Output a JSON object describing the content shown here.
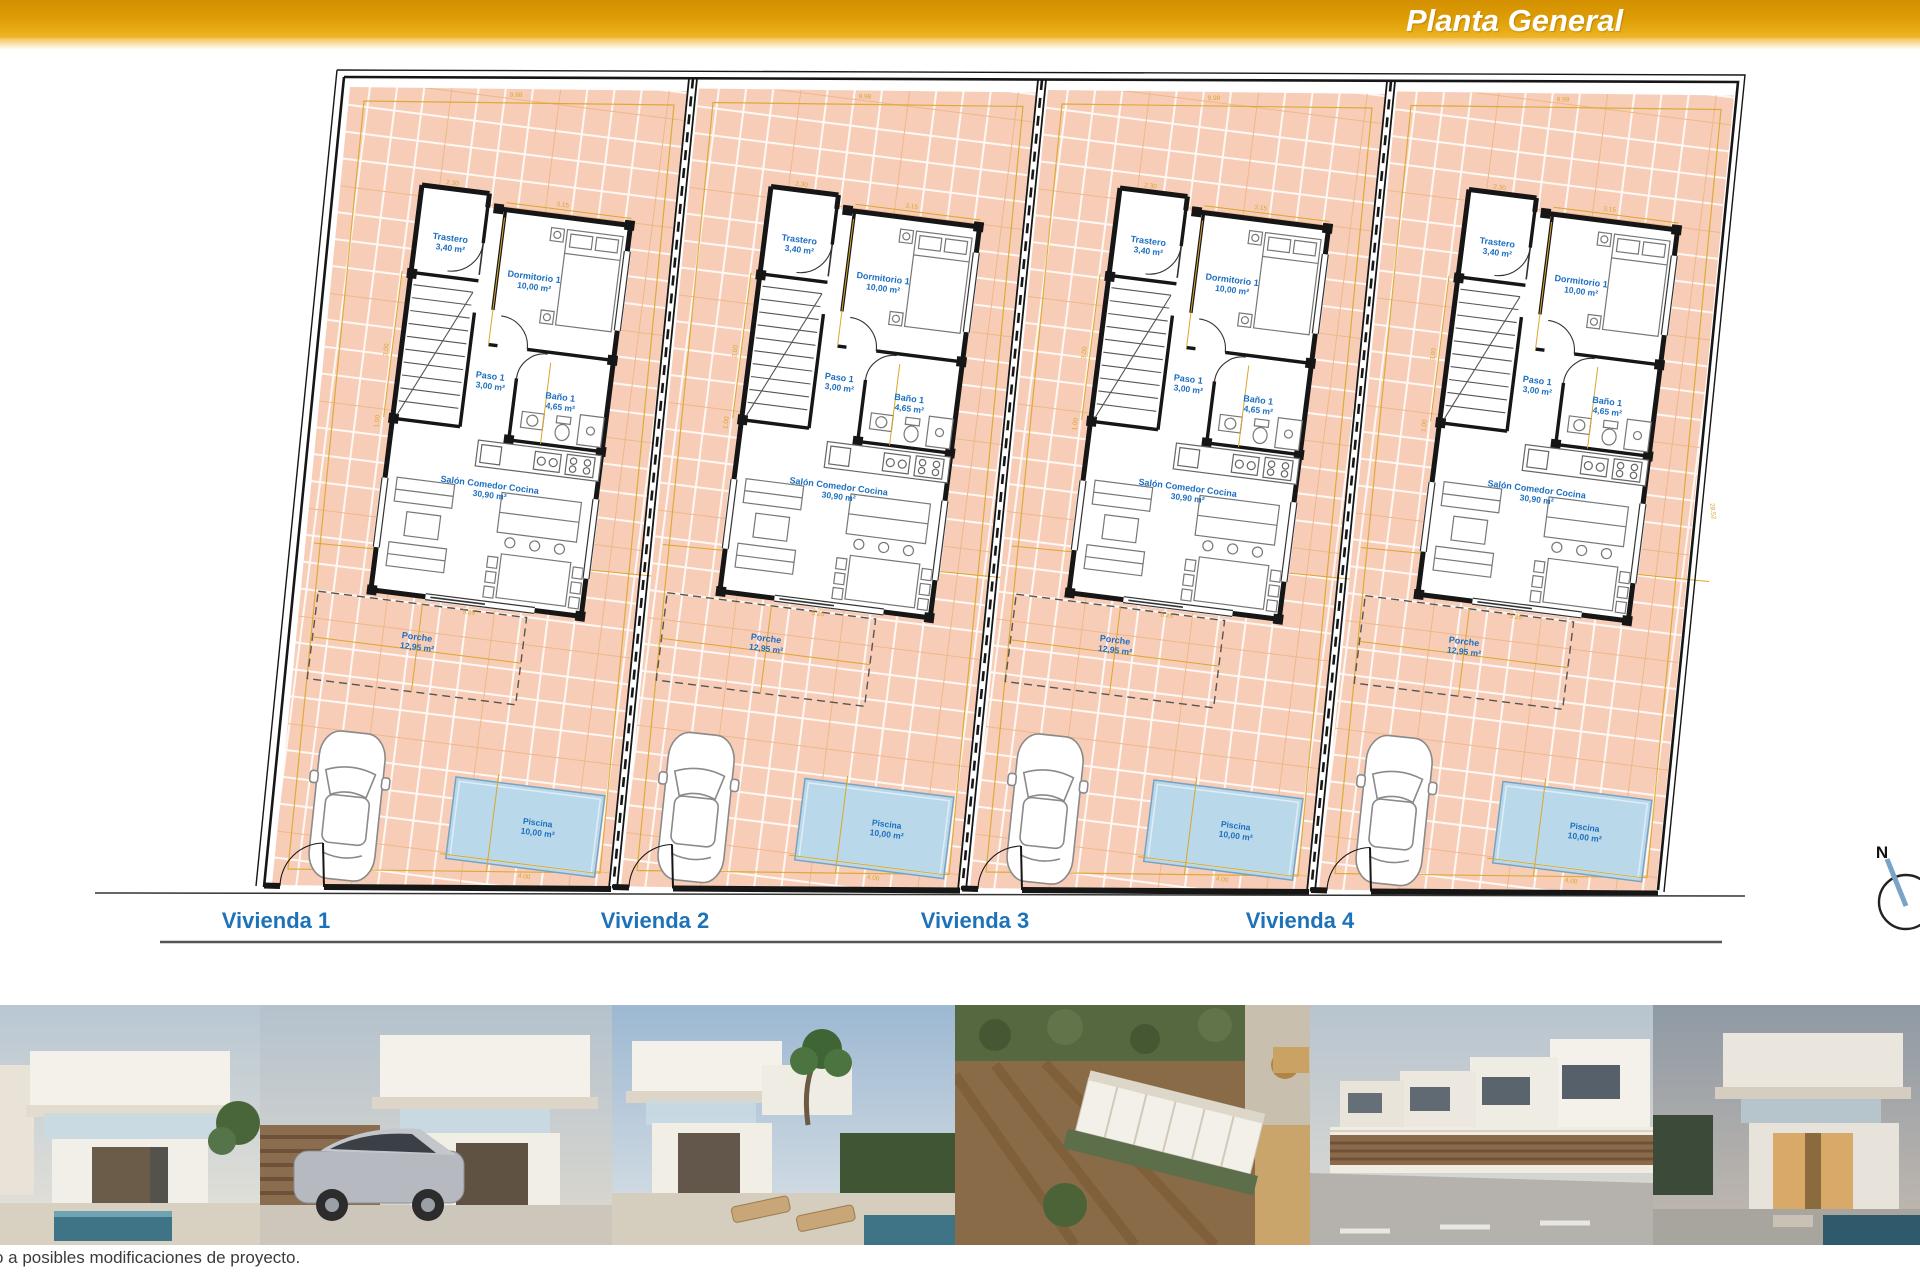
{
  "header": {
    "title": "Planta General"
  },
  "plan": {
    "viviendas": [
      "Vivienda 1",
      "Vivienda 2",
      "Vivienda 3",
      "Vivienda 4"
    ],
    "rooms": [
      {
        "name": "Trastero",
        "area": "3,40 m²"
      },
      {
        "name": "Dormitorio 1",
        "area": "10,00 m²"
      },
      {
        "name": "Paso 1",
        "area": "3,00 m²"
      },
      {
        "name": "Baño 1",
        "area": "4,65 m²"
      },
      {
        "name": "Salón Comedor Cocina",
        "area": "30,90 m²"
      }
    ],
    "porch": {
      "name": "Porche",
      "area": "12,95 m²"
    },
    "pool": {
      "name": "Piscina",
      "area": "10,00 m²"
    },
    "dimensions": [
      "3.15",
      "2.30",
      "3.00",
      "1.00",
      "9.98",
      "4.00",
      "28.52",
      "5.25"
    ],
    "compass_label": "N",
    "colors": {
      "parcel_fill": "#f8cdb8",
      "grid_line": "#ffffff",
      "grid_accent": "#eaa86b",
      "wall": "#161616",
      "room_label_blue": "#1d6fc0",
      "vivienda_blue": "#1e72b8",
      "dimension_gold": "#d9a72c",
      "pool_fill": "#b9d8ea",
      "pool_edge": "#76a3c4",
      "header_gold": "#dd9c05"
    }
  },
  "footer": {
    "caption": "o a posibles modificaciones de proyecto."
  },
  "photos": [
    {
      "name": "render-villa-front-pool"
    },
    {
      "name": "render-villa-driveway-car"
    },
    {
      "name": "render-villa-garden-loungers"
    },
    {
      "name": "render-aerial-development"
    },
    {
      "name": "render-street-row-villas"
    },
    {
      "name": "render-villa-dusk-pool"
    }
  ]
}
